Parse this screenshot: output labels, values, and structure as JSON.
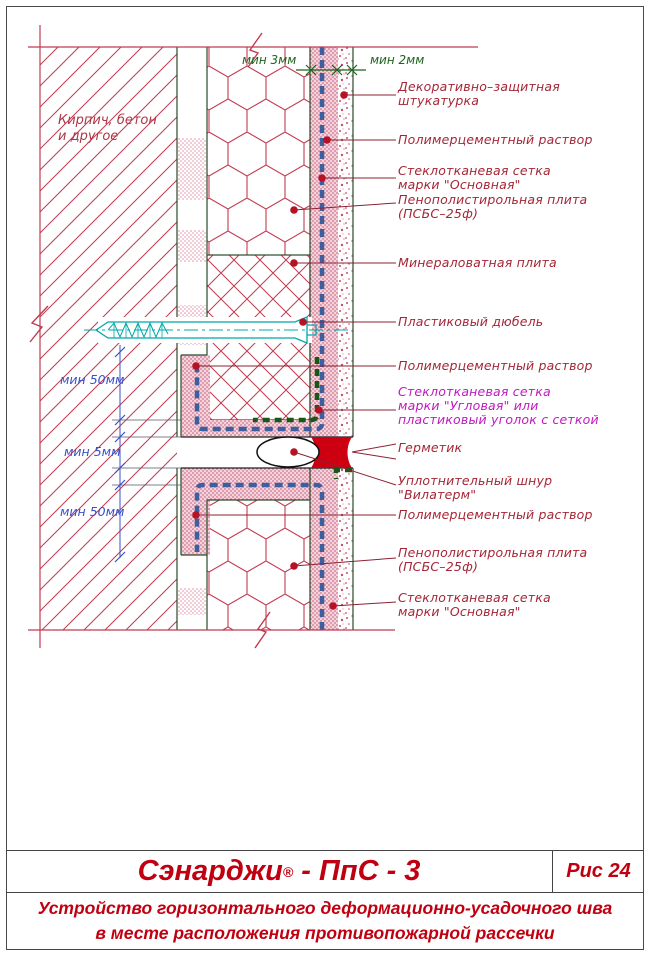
{
  "colors": {
    "line_red": "#c23b50",
    "label_red": "#a52636",
    "label_magenta": "#c019c0",
    "dim_green": "#1c641c",
    "dim_blue": "#3a50c8",
    "mesh_blue": "#3f5e9e",
    "mesh_green": "#175817",
    "dowel_cyan": "#00a8a8",
    "sealant_red": "#cc0011",
    "title_red": "#c00010"
  },
  "drawing": {
    "wall_label": "Кирпич,  бетон\nи  другое",
    "dim_top_1": "мин  3мм",
    "dim_top_2": "мин  2мм",
    "dim_left_1": "мин  50мм",
    "dim_left_2": "мин  5мм",
    "dim_left_3": "мин  50мм",
    "labels": [
      {
        "text": "Декоративно–защитная\nштукатурка"
      },
      {
        "text": "Полимерцементный  раствор"
      },
      {
        "text": "Стеклотканевая  сетка\nмарки  \"Основная\""
      },
      {
        "text": "Пенополистирольная  плита\n(ПСБС–25ф)"
      },
      {
        "text": "Минераловатная  плита"
      },
      {
        "text": "Пластиковый  дюбель"
      },
      {
        "text": "Полимерцементный  раствор"
      },
      {
        "text": "Стеклотканевая  сетка\nмарки  \"Угловая\"  или\nпластиковый  уголок  с  сеткой"
      },
      {
        "text": "Герметик"
      },
      {
        "text": "Уплотнительный  шнур\n\"Вилатерм\""
      },
      {
        "text": "Полимерцементный  раствор"
      },
      {
        "text": "Пенополистирольная  плита\n(ПСБС–25ф)"
      },
      {
        "text": "Стеклотканевая  сетка\nмарки  \"Основная\""
      }
    ]
  },
  "titleblock": {
    "brand": "Сэнарджи",
    "reg_mark": "®",
    "series": " - ПпС - 3",
    "figure": "Рис 24",
    "caption_line1": "Устройство горизонтального деформационно-усадочного шва",
    "caption_line2": "в месте расположения противопожарной рассечки"
  }
}
